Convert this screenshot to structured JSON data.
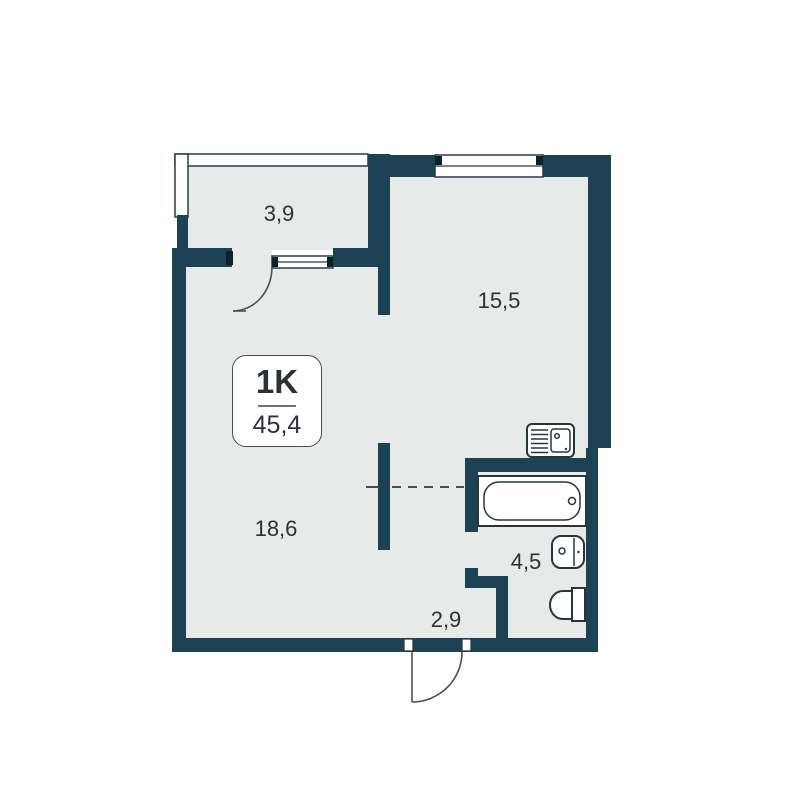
{
  "plan": {
    "unit_label": "1K",
    "total_area": "45,4",
    "rooms": {
      "balcony": "3,9",
      "kitchen": "15,5",
      "living": "18,6",
      "bathroom": "4,5",
      "hallway": "2,9"
    },
    "icons": [
      "bathtub-icon",
      "kitchen-sink-icon",
      "washbasin-icon",
      "toilet-icon",
      "entrance-door-arc-icon",
      "balcony-door-arc-icon"
    ],
    "colors": {
      "wall": "#1c4253",
      "floor": "#e8e9e9",
      "background": "#ffffff",
      "text": "#2b3236",
      "fixture_outline": "#28353c"
    }
  }
}
